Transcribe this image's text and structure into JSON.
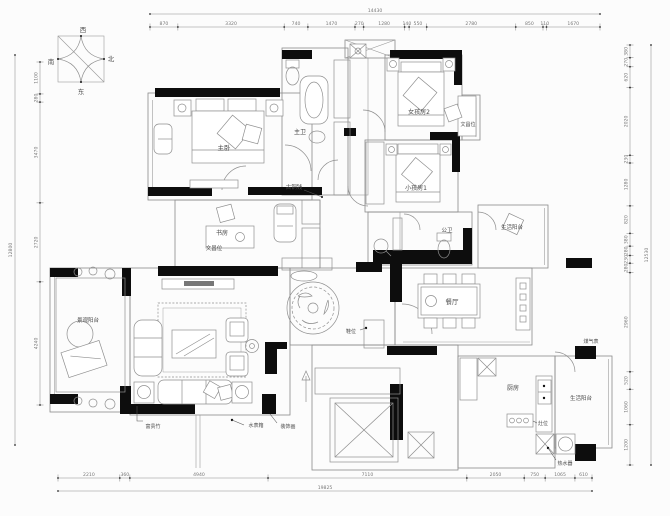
{
  "compass": {
    "west": "西",
    "north": "北",
    "south": "南",
    "east": "东"
  },
  "rooms": {
    "master_bedroom": "主卧",
    "master_bath": "主卫",
    "study": "书房",
    "study_wenchang": "文昌位",
    "girl_room2": "女孩房2",
    "girl_wenchang": "文昌位",
    "kid_room1": "小孩房1",
    "public_bath": "公卫",
    "side_balcony": "生活阳台",
    "dining": "餐厅",
    "kitchen": "厨房",
    "stove": "灶位",
    "kitchen_balcony": "生活阳台",
    "view_balcony": "景观阳台"
  },
  "annotations": {
    "bronze_coin": "古铜钱",
    "gas_meter": "煤气表",
    "water_heater": "热水器",
    "shoe_spot": "鞋位",
    "lucky_bamboo": "富贵竹",
    "water_meter_box": "水表箱",
    "decor_painting": "装饰画"
  },
  "dimensions": {
    "top": {
      "total": "14430",
      "segments": [
        "870",
        "3320",
        "740",
        "1470",
        "270",
        "1280",
        "140",
        "550",
        "2780",
        "850",
        "110",
        "1670"
      ]
    },
    "bottom": {
      "total": "19825",
      "segments": [
        "2210",
        "360",
        "4940",
        "7110",
        "2050",
        "750",
        "1065",
        "610"
      ]
    },
    "left": {
      "total": "12800",
      "segments": [
        "1100",
        "280",
        "3470",
        "2720",
        "4240"
      ]
    },
    "right": {
      "total": "12530",
      "segments": [
        "380",
        "270",
        "620",
        "2020",
        "230",
        "1280",
        "820",
        "380",
        "280",
        "230",
        "280",
        "2960",
        "520",
        "1060",
        "1200"
      ]
    }
  },
  "colors": {
    "wall": "#111111",
    "line": "#8a8a8a",
    "background": "#fcfcfc"
  }
}
